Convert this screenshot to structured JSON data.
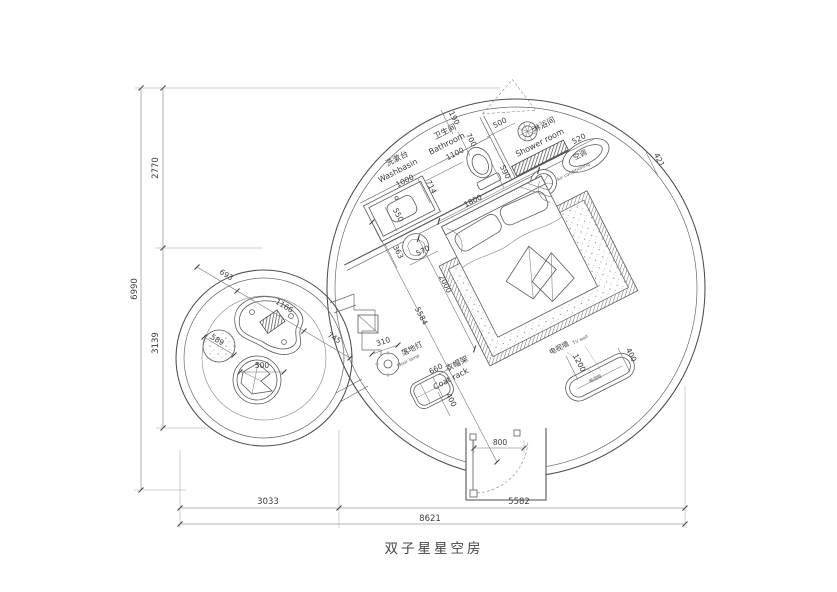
{
  "drawing_title": "双子星星空房",
  "labels": {
    "washbasin_cn": "洗漱台",
    "washbasin_en": "Washbasin",
    "bathroom_cn": "卫生间",
    "bathroom_en": "Bathroom",
    "shower_cn": "淋浴间",
    "shower_en": "Shower room",
    "ac_cn": "空调",
    "ac_en": "Air conditioning",
    "floor_lamp_cn": "落地灯",
    "floor_lamp_en": "Floor lamp",
    "coat_rack_cn": "衣帽架",
    "coat_rack_en": "Coat rack",
    "tv_wall_cn": "电视墙",
    "tv_wall_en": "TV wall",
    "tv_cabinet_cn": "电视柜"
  },
  "dims": {
    "overall_w": "8621",
    "left_w": "3033",
    "right_w": "5582",
    "overall_h": "6990",
    "top_h": "2770",
    "mid_h": "3139",
    "gap_190": "190",
    "toilet_700": "700",
    "shower_door_500": "500",
    "ac_520": "520",
    "ac_421": "421",
    "drain_590": "590",
    "counter_714": "714",
    "counter_550": "550",
    "washbasin_1000": "1000",
    "bathroom_1100": "1100",
    "bed_w": "1800",
    "bed_l": "2000",
    "stool_363": "363",
    "stool_570": "570",
    "diag_5584": "5584",
    "lamp_310": "310",
    "rack_660": "660",
    "rack_400": "400",
    "tv_1200": "1200",
    "tv_400": "400",
    "door_800": "800",
    "pod_693": "693",
    "pod_1166": "1166",
    "pod_745": "745",
    "pod_589": "589",
    "pod_500": "500"
  }
}
